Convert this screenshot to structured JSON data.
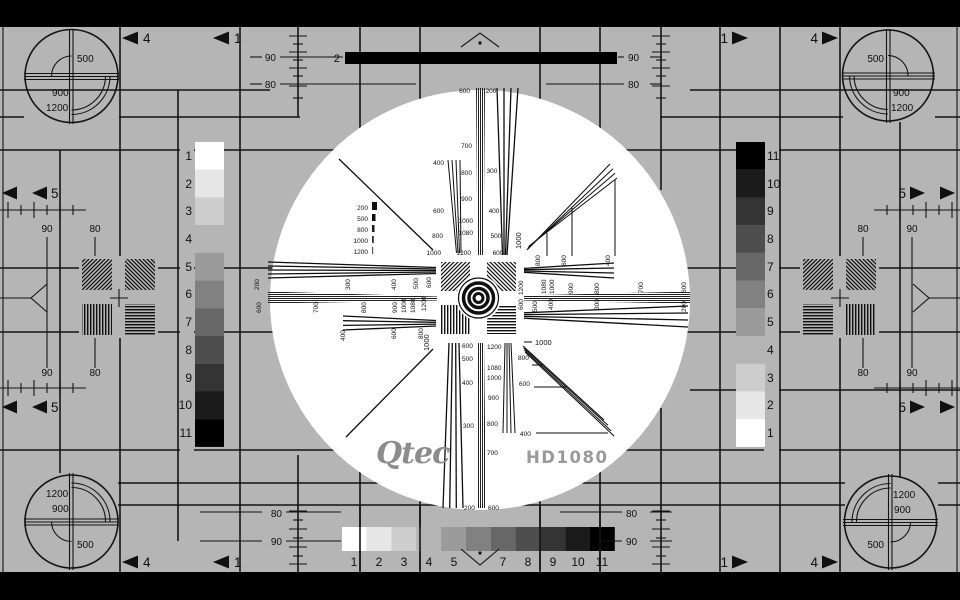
{
  "colors": {
    "bg": "#b5b5b5",
    "ink": "#141414",
    "white": "#ffffff",
    "logo_gray": "#8c8c8c",
    "model_gray": "#9a9a9a",
    "bar_black": "#000000"
  },
  "refs": {
    "n80": "80",
    "n90": "90"
  },
  "arrows": {
    "one": "1",
    "four": "4",
    "five": "5"
  },
  "top": {
    "bar_label": "2"
  },
  "corners": {
    "tl": [
      "500",
      "900",
      "1200"
    ],
    "tr": [
      "500",
      "900",
      "1200"
    ],
    "bl": [
      "1200",
      "900",
      "500"
    ],
    "br": [
      "1200",
      "900",
      "500"
    ]
  },
  "gs": {
    "colors": [
      "#ffffff",
      "#e6e6e6",
      "#cdcdcd",
      "#b4b4b4",
      "#9b9b9b",
      "#818181",
      "#676767",
      "#4e4e4e",
      "#343434",
      "#1b1b1b",
      "#000000"
    ],
    "left": [
      "1",
      "2",
      "3",
      "4",
      "5",
      "6",
      "7",
      "8",
      "9",
      "10",
      "11"
    ],
    "right": [
      "11",
      "10",
      "9",
      "8",
      "7",
      "6",
      "5",
      "4",
      "3",
      "2",
      "1"
    ],
    "bar": [
      "1",
      "2",
      "3",
      "4",
      "5",
      "7",
      "8",
      "9",
      "10",
      "11"
    ]
  },
  "legend": [
    "200",
    "500",
    "800",
    "1000",
    "1200"
  ],
  "wedges": {
    "top_small": [
      "400",
      "600",
      "800",
      "1000"
    ],
    "top_fine": [
      "600",
      "700",
      "800",
      "900",
      "1000",
      "1080",
      "1200"
    ],
    "top_coarse": [
      "200",
      "300",
      "400",
      "500",
      "600"
    ],
    "bottom_coarse": [
      "600",
      "500",
      "400",
      "300",
      "200"
    ],
    "bottom_fine": [
      "1200",
      "1080",
      "1000",
      "900",
      "800",
      "700",
      "600"
    ],
    "bottom_small": [
      "800",
      "600",
      "400"
    ],
    "left_r1": [
      "200",
      "300",
      "400",
      "500",
      "600"
    ],
    "left_r2": [
      "600",
      "700",
      "800",
      "900",
      "1000",
      "1080",
      "1200"
    ],
    "left_r3": [
      "400",
      "600",
      "800"
    ],
    "right_ra": [
      "800",
      "600",
      "400"
    ],
    "right_rb": [
      "1200",
      "1080",
      "1000",
      "900",
      "800",
      "700",
      "600"
    ],
    "right_rc": [
      "600",
      "500",
      "400",
      "300",
      "200"
    ],
    "diag": "1000"
  },
  "branding": {
    "logo": "Qtec",
    "model": "HD1080"
  }
}
